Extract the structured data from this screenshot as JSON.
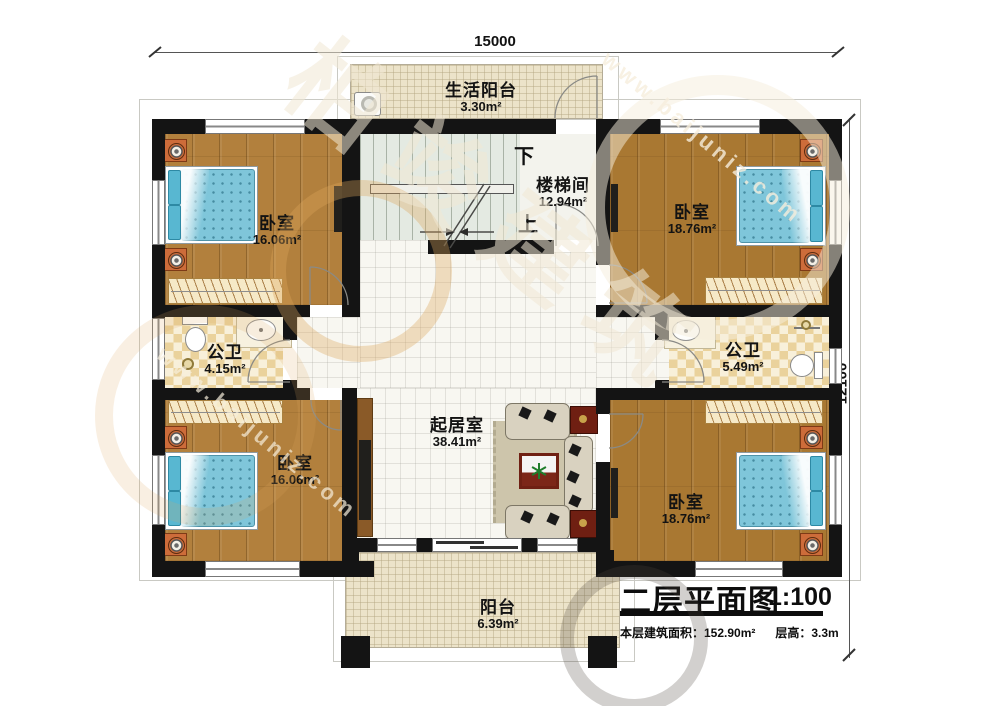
{
  "dimensions": {
    "top": "15000",
    "right": "12100"
  },
  "rooms": {
    "life_balcony": {
      "name": "生活阳台",
      "area": "3.30m²"
    },
    "stairwell": {
      "name": "楼梯间",
      "area": "12.94m²",
      "down": "下",
      "up": "上"
    },
    "bedroom_top_left": {
      "name": "卧室",
      "area": "16.06m²"
    },
    "bedroom_top_right": {
      "name": "卧室",
      "area": "18.76m²"
    },
    "bathroom_left": {
      "name": "公卫",
      "area": "4.15m²"
    },
    "bathroom_right": {
      "name": "公卫",
      "area": "5.49m²"
    },
    "living_room": {
      "name": "起居室",
      "area": "38.41m²"
    },
    "bedroom_bottom_left": {
      "name": "卧室",
      "area": "16.06m²"
    },
    "bedroom_bottom_right": {
      "name": "卧室",
      "area": "18.76m²"
    },
    "balcony": {
      "name": "阳台",
      "area": "6.39m²"
    }
  },
  "title_block": {
    "title": "二层平面图",
    "scale": "1:100",
    "floor_area": "本层建筑面积：152.90m²",
    "floor_height": "层高：3.3m"
  },
  "watermark": {
    "brand": "柏竣建筑",
    "site": "www.baijuniz.com"
  },
  "colors": {
    "wall": "#141414",
    "wood_light": "#b2803d",
    "wood_dark": "#a97832",
    "bed_blue": "#7fc6da",
    "accent_red": "#6f1f12",
    "tile_cream": "#ece3c9"
  }
}
